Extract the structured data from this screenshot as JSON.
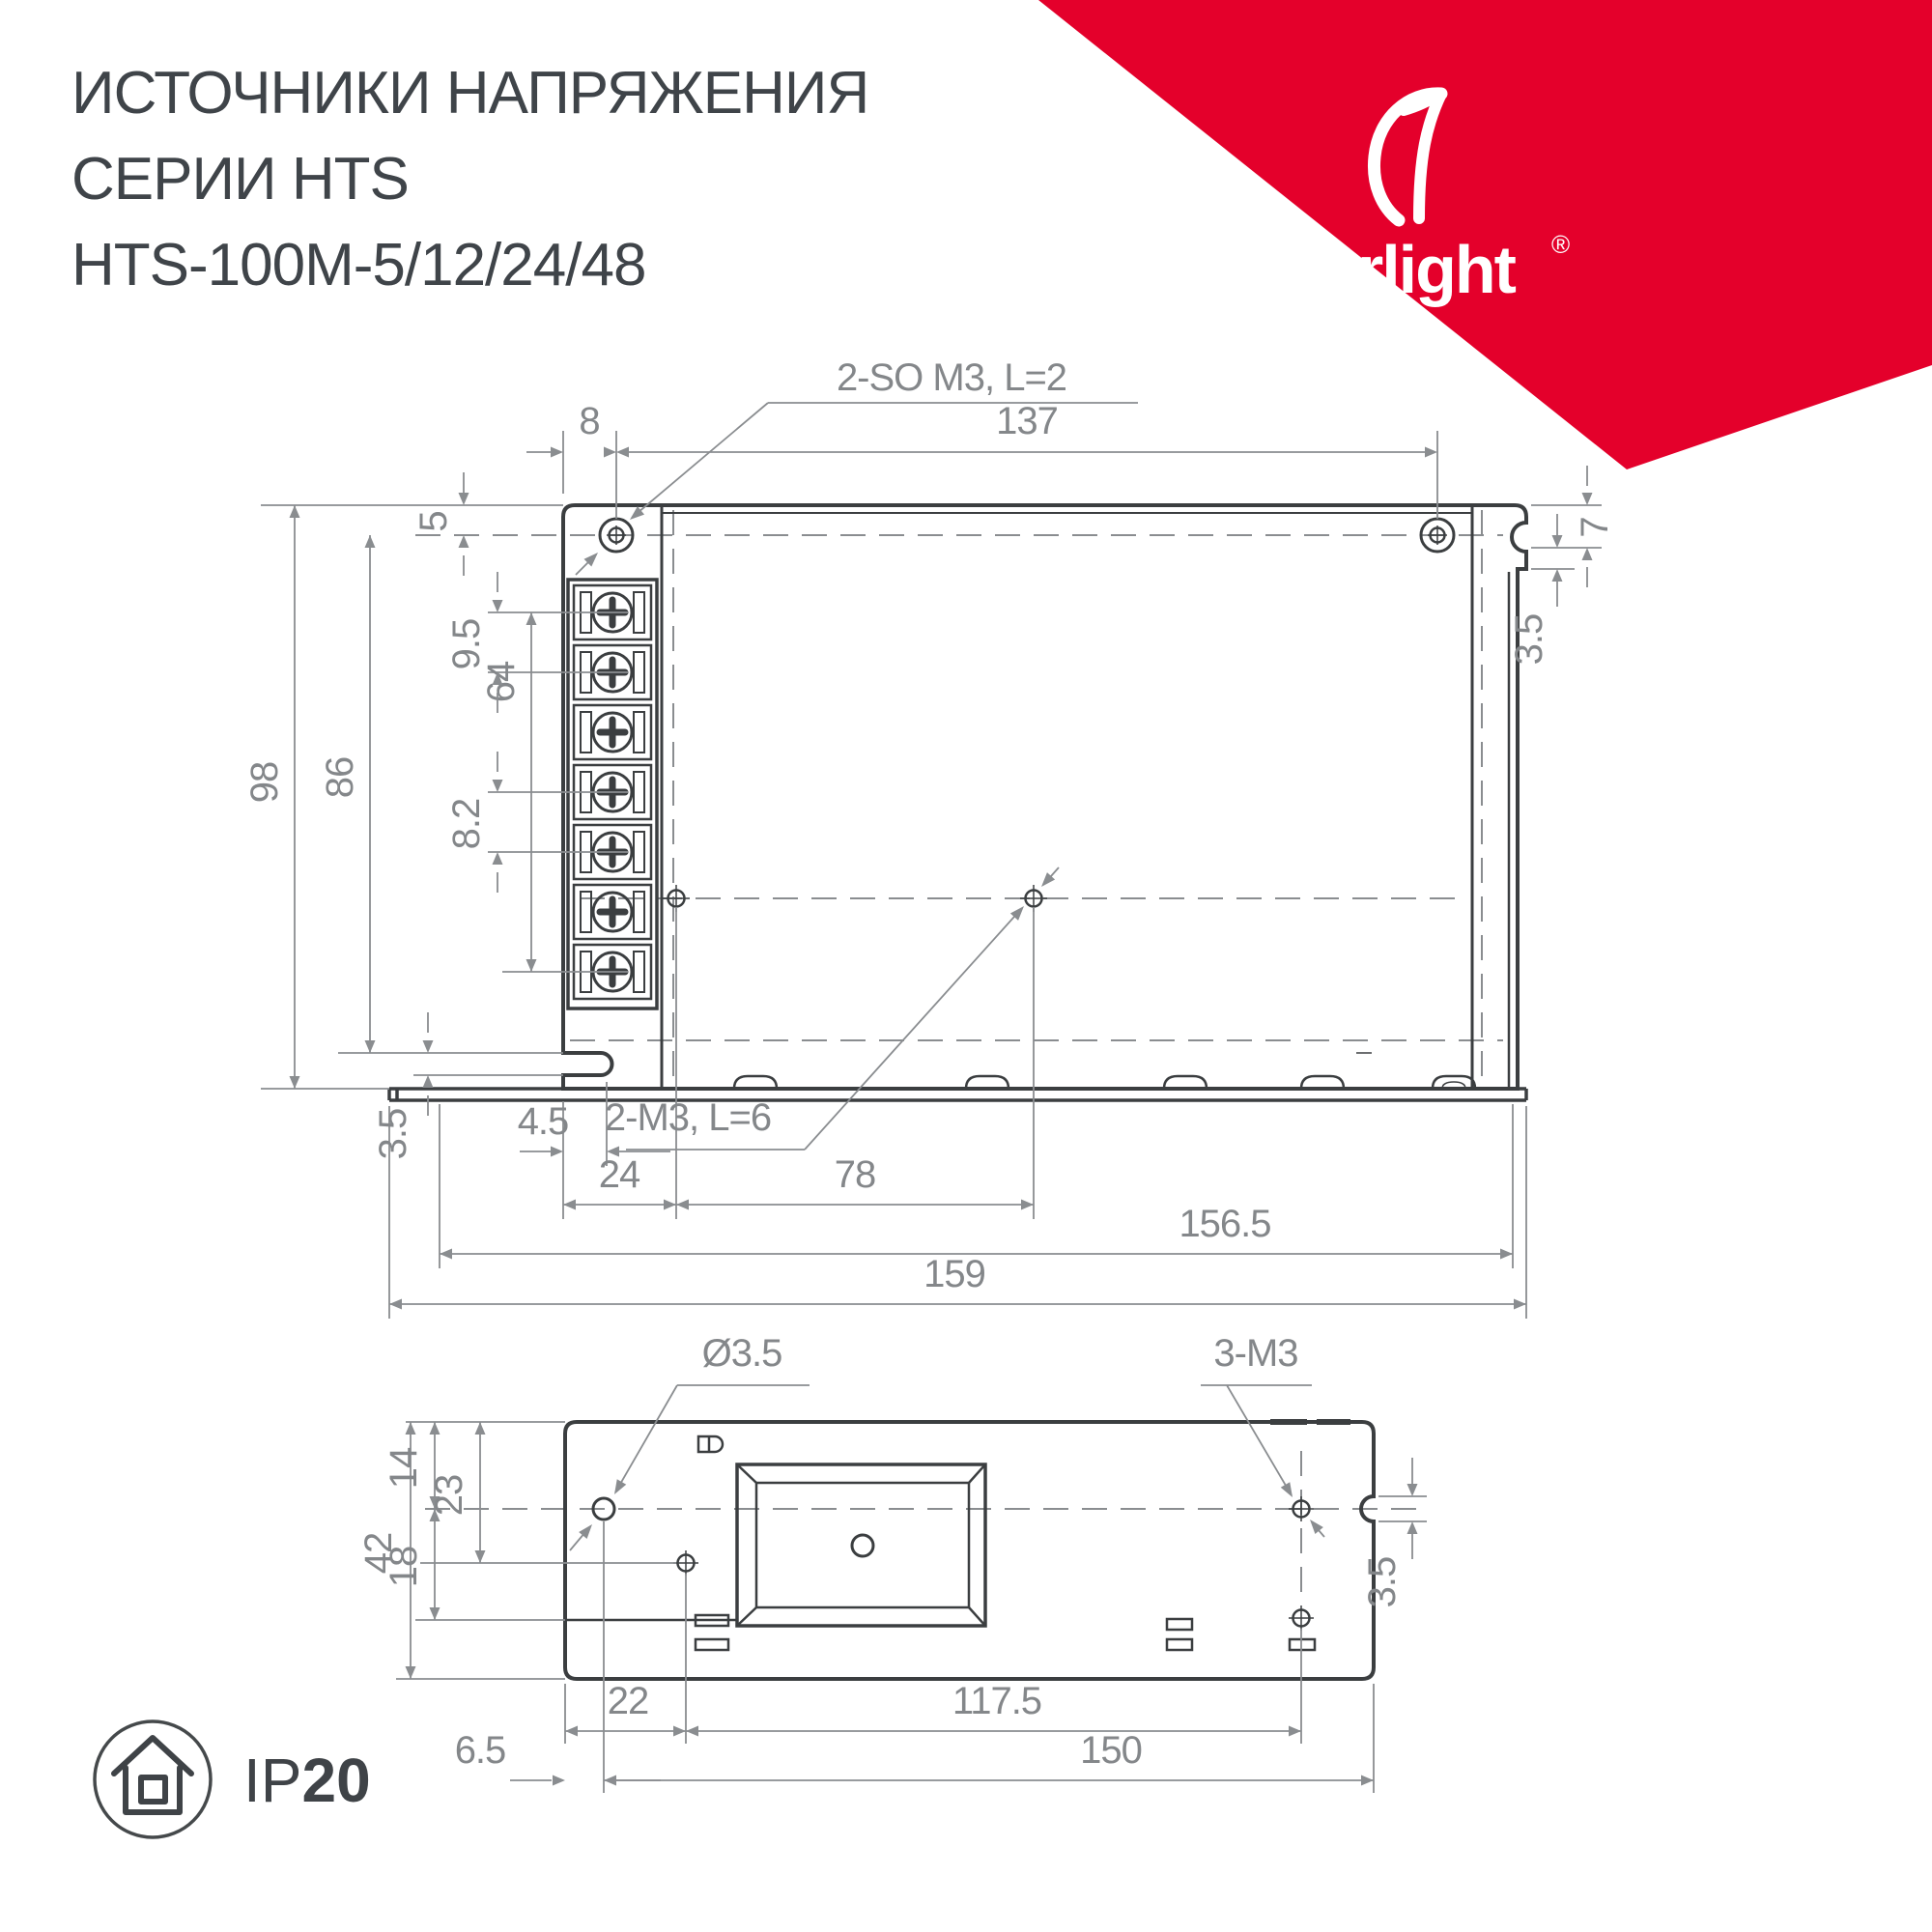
{
  "title": {
    "line1": "ИСТОЧНИКИ НАПРЯЖЕНИЯ",
    "line2": "СЕРИИ HTS",
    "line3": "HTS-100M-5/12/24/48"
  },
  "brand": {
    "name": "arlight",
    "registered": "®",
    "banner_color": "#E4002B"
  },
  "colors": {
    "outline": "#3B3E40",
    "dimension": "#8A8D90",
    "text": "#3F4449"
  },
  "top_view": {
    "callout_top": "2-SO M3, L=2",
    "callout_mid": "2-M3, L=6",
    "dims": {
      "d8": "8",
      "d137": "137",
      "d5": "5",
      "d9_5": "9.5",
      "d64": "64",
      "d8_2": "8.2",
      "d98": "98",
      "d86": "86",
      "d3_5_left": "3.5",
      "d4_5": "4.5",
      "d24": "24",
      "d78": "78",
      "d156_5": "156.5",
      "d159": "159",
      "d7": "7",
      "d3_5_right": "3.5"
    }
  },
  "bottom_view": {
    "callout_hole": "Ø3.5",
    "callout_m3": "3-M3",
    "dims": {
      "d14": "14",
      "d23": "23",
      "d42": "42",
      "d18": "18",
      "d22": "22",
      "d117_5": "117.5",
      "d6_5": "6.5",
      "d150": "150",
      "d3_5": "3.5"
    }
  },
  "badge": {
    "ip": "IP",
    "rating": "20"
  }
}
